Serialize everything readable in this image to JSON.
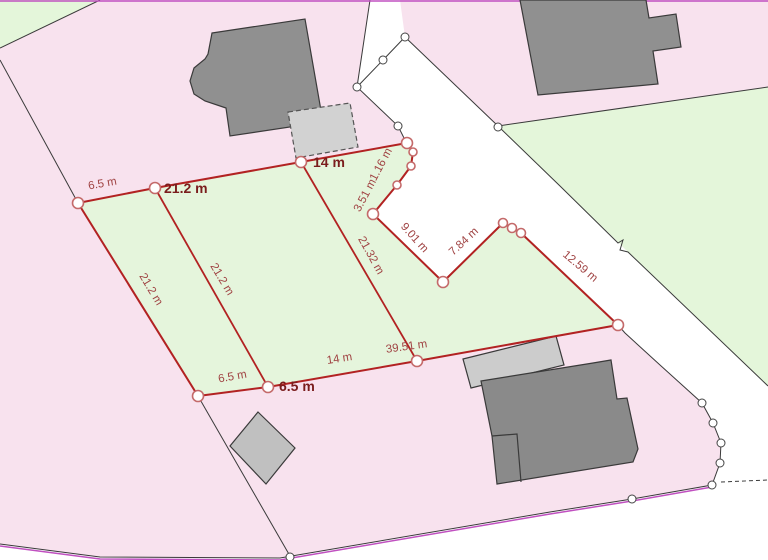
{
  "map": {
    "title": "Cadastral parcel map with survey measurements",
    "unit": "m",
    "colors": {
      "parcel_pink": "#f8e2ee",
      "parcel_green": "#e4f6da",
      "road_white": "#ffffff",
      "boundary_black": "#3a3a3a",
      "frame_magenta": "#c050c0",
      "measure_red": "#b22222",
      "label_regular": "#a04343",
      "label_bold": "#7a1d1d",
      "building_dark": "#909090",
      "building_light": "#cfcfcf",
      "vertex_ring": "#c46a6a"
    },
    "measurements": {
      "labels": [
        {
          "text": "6.5 m",
          "bold": false
        },
        {
          "text": "21.2 m",
          "bold": true
        },
        {
          "text": "14 m",
          "bold": true
        },
        {
          "text": "3.51 m",
          "bold": false
        },
        {
          "text": "1.16 m",
          "bold": false
        },
        {
          "text": "9.01 m",
          "bold": false
        },
        {
          "text": "7.84 m",
          "bold": false
        },
        {
          "text": "12.59 m",
          "bold": false
        },
        {
          "text": "21.32 m",
          "bold": false
        },
        {
          "text": "21.2 m",
          "bold": false
        },
        {
          "text": "21.2 m",
          "bold": false
        },
        {
          "text": "6.5 m",
          "bold": false
        },
        {
          "text": "6.5 m",
          "bold": true
        },
        {
          "text": "14 m",
          "bold": false
        },
        {
          "text": "39.51 m",
          "bold": false
        }
      ]
    }
  }
}
